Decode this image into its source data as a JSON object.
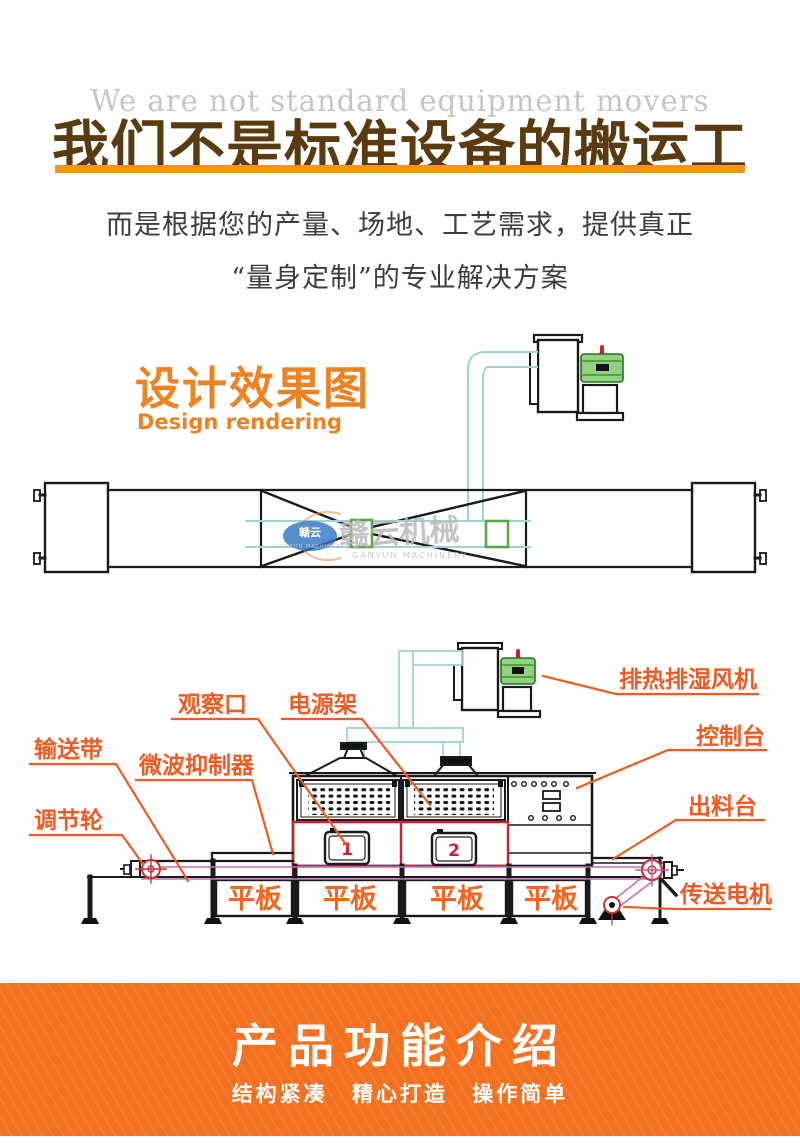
{
  "header": {
    "watermark_en": "We are not standard equipment movers",
    "title": "我们不是标准设备的搬运工",
    "subtitle_line1": "而是根据您的产量、场地、工艺需求，提供真正",
    "subtitle_line2": "“量身定制”的专业解决方案"
  },
  "design_section": {
    "title_cn": "设计效果图",
    "title_en": "Design rendering"
  },
  "brand_watermark": {
    "badge_text": "赣云",
    "name_cn": "赣云机械",
    "name_en": "GANYUN MACHINERY"
  },
  "diagram_labels": {
    "exhaust_fan": "排热排湿风机",
    "control_console": "控制台",
    "discharge_table": "出料台",
    "conveyor_motor": "传送电机",
    "observation_port": "观察口",
    "power_rack": "电源架",
    "conveyor_belt": "输送带",
    "microwave_suppressor": "微波抑制器",
    "adjust_wheel": "调节轮",
    "flat_plate": "平板",
    "window_1": "1",
    "window_2": "2"
  },
  "footer": {
    "title": "产品功能介绍",
    "tagline": "结构紧凑 精心打造 操作简单"
  },
  "colors": {
    "heading_brown": "#5a3a0f",
    "underline_orange": "#f7941d",
    "accent_orange": "#ef8220",
    "label_orange": "#f15a22",
    "line_black": "#1a1a1a",
    "highlight_red": "#cf2030",
    "wheel_red": "#cc3333",
    "belt_magenta": "#bf6fbf",
    "duct_cyan": "#9fd4d4",
    "motor_green": "#8ed47e",
    "green_frame": "#5ba646",
    "footer_orange": "#f3701e"
  }
}
